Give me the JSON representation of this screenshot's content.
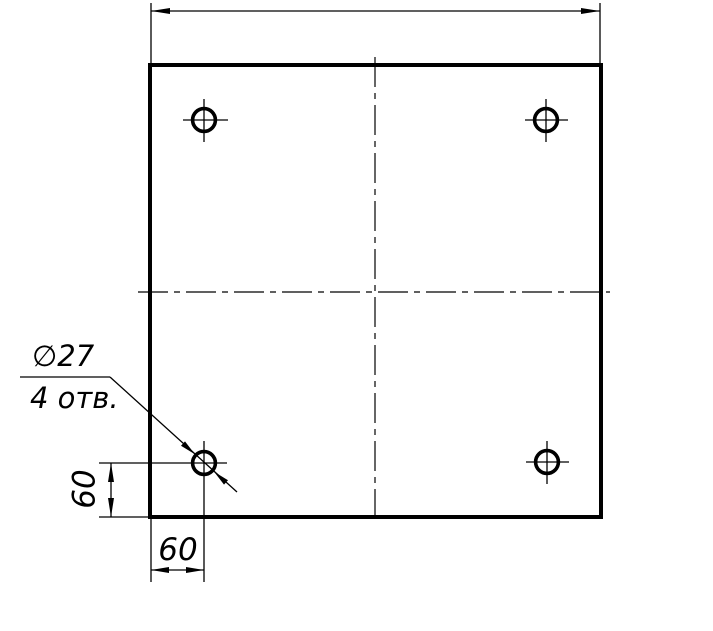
{
  "drawing": {
    "callout": {
      "diameter_label": "∅27",
      "count_label": "4 отв."
    },
    "dimensions": {
      "vertical_offset": "60",
      "horizontal_offset": "60",
      "top_width_label": ""
    },
    "colors": {
      "ink": "#000000",
      "paper": "#ffffff"
    }
  }
}
